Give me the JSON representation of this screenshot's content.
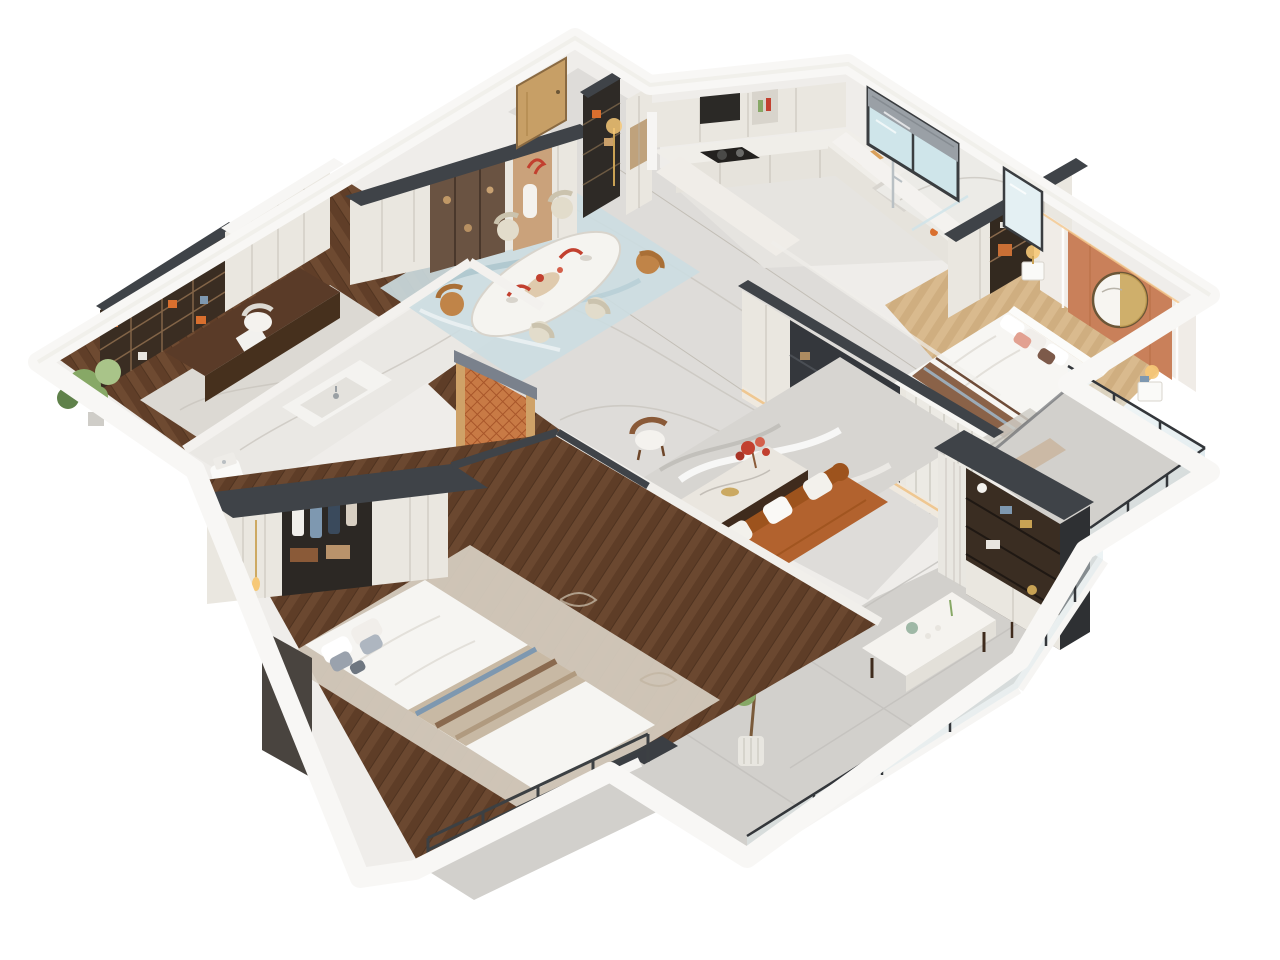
{
  "meta": {
    "type": "3d-isometric-floor-plan-render",
    "style": "modern apartment cutaway, top-down axonometric view, no visible text",
    "background": "#ffffff"
  },
  "palette": {
    "bg": "#ffffff",
    "wallTop": "#f7f6f4",
    "wallFace": "#eceae6",
    "charcoal": "#3f4348",
    "marbleHall": "#dedcd9",
    "marbleBath": "#eae8e4",
    "woodDark": "#6b4830",
    "oakLight": "#d9ba8e",
    "tileGray": "#d2d0cc",
    "cabinet": "#eae7e0",
    "shelfDark": "#3a2d22",
    "accent": "#c9805a",
    "lattice": "#c87a45",
    "sofa": "#b2622e",
    "tealRug": "#ccdde1",
    "green": "#87a866",
    "gold": "#c8a254",
    "glass": "#dfeef1",
    "salmon": "#e2a191"
  },
  "rooms": [
    {
      "id": "study",
      "name": "Study",
      "floor": "dark wood + marble rug",
      "furniture": [
        "bookshelf with orange decor",
        "white cabinets",
        "dark wood desk",
        "white office chair",
        "potted plant"
      ]
    },
    {
      "id": "middle-bathroom",
      "name": "Bathroom",
      "floor": "marble",
      "furniture": [
        "vanity with basin",
        "toilet"
      ]
    },
    {
      "id": "dining",
      "name": "Dining room",
      "floor": "gray marble + teal rug",
      "furniture": [
        "oval marble dining table",
        "six chairs",
        "display cabinet with smoked glass",
        "lit niche with red flowers",
        "orange lattice screen partition"
      ]
    },
    {
      "id": "entry",
      "name": "Entry hall",
      "furniture": [
        "wood entry door",
        "dark open shelf",
        "gold floor lamp",
        "pantry column"
      ]
    },
    {
      "id": "kitchen",
      "name": "Kitchen",
      "floor": "light marble",
      "furniture": [
        "L-shaped white counter",
        "gas stove with pot",
        "range hood",
        "upper cabinets",
        "window with roller blind",
        "sink",
        "cutting board"
      ]
    },
    {
      "id": "shower-bath",
      "name": "Shower bathroom",
      "floor": "marble",
      "furniture": [
        "rain shower set",
        "tall lit mirror"
      ]
    },
    {
      "id": "master-bedroom",
      "name": "Master bedroom",
      "floor": "light oak",
      "furniture": [
        "wardrobe row with open shelves",
        "terracotta accent wall",
        "round gold mirror",
        "double bed with salmon pillows",
        "two nightstands with lamps",
        "balcony with glass railing"
      ]
    },
    {
      "id": "living",
      "name": "Living room",
      "floor": "gray marble + gray rug",
      "furniture": [
        "media wall with dark niche and lit marble ledge",
        "cognac leather sofa with white cushions",
        "marble coffee table with red bouquet",
        "wood armchair"
      ]
    },
    {
      "id": "tea-balcony",
      "name": "Tea balcony",
      "floor": "gray tile",
      "furniture": [
        "white tea table with tea set",
        "wood armchair",
        "potted tree",
        "dark bookshelf unit",
        "glass railing"
      ]
    },
    {
      "id": "second-bedroom",
      "name": "Second bedroom",
      "floor": "dark wood",
      "furniture": [
        "wardrobe with open hanging section",
        "gold pendant light",
        "bed with blue-brown striped runner",
        "dark footboard bench",
        "beige patterned rug",
        "balcony with bar railing"
      ]
    }
  ]
}
